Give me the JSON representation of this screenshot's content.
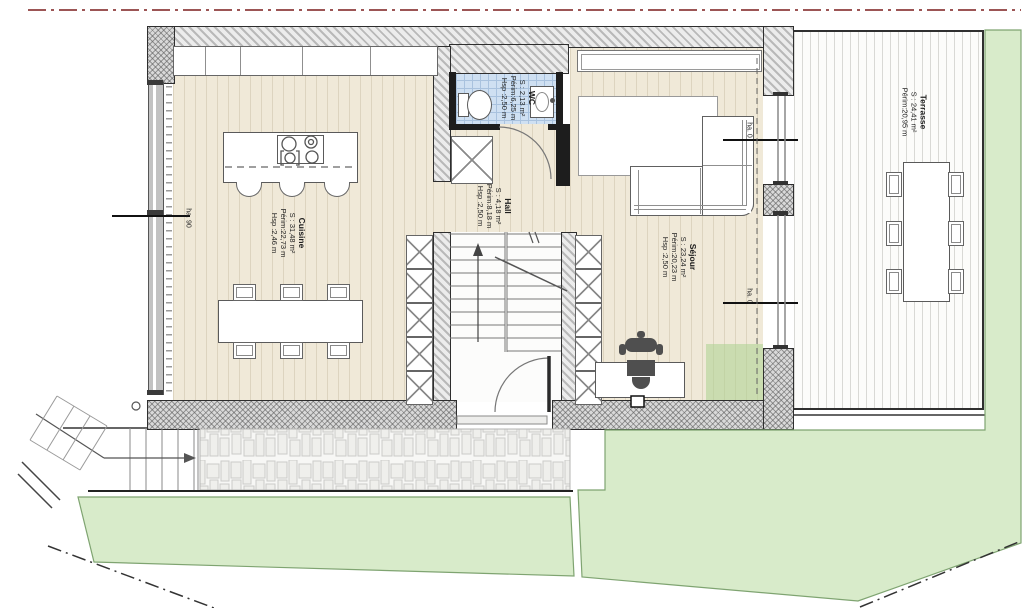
{
  "plan": {
    "title": "Floor plan – ground level",
    "rooms": [
      {
        "name": "Cuisine",
        "area": "S : 31,48 m²",
        "perimeter": "Périm:22,73 m",
        "height": "Hsp :2,46 m"
      },
      {
        "name": "Hall",
        "area": "S : 4,18 m²",
        "perimeter": "Périm:8,18 m",
        "height": "Hsp :2,50 m"
      },
      {
        "name": "WC",
        "area": "S : 2,13 m²",
        "perimeter": "Périm:6,25 m",
        "height": "Hsp :2,50 m"
      },
      {
        "name": "Séjour",
        "area": "S : 23,24 m²",
        "perimeter": "Périm:20,23 m",
        "height": "Hsp :2,50 m"
      },
      {
        "name": "Terrasse",
        "area": "S : 24,41 m²",
        "perimeter": "Périm:20,95 m"
      }
    ],
    "dims": {
      "left_wall": "ha. 90",
      "right_upper": "ha. 0",
      "right_lower": "ha. 0"
    },
    "colors": {
      "boundary_red": "#7c1d1d",
      "floor_wood": "#f0e9d8",
      "wc_tile": "#cfe0f2",
      "lawn": "#d8ebca",
      "wall_gray": "#d9d9d9"
    }
  }
}
